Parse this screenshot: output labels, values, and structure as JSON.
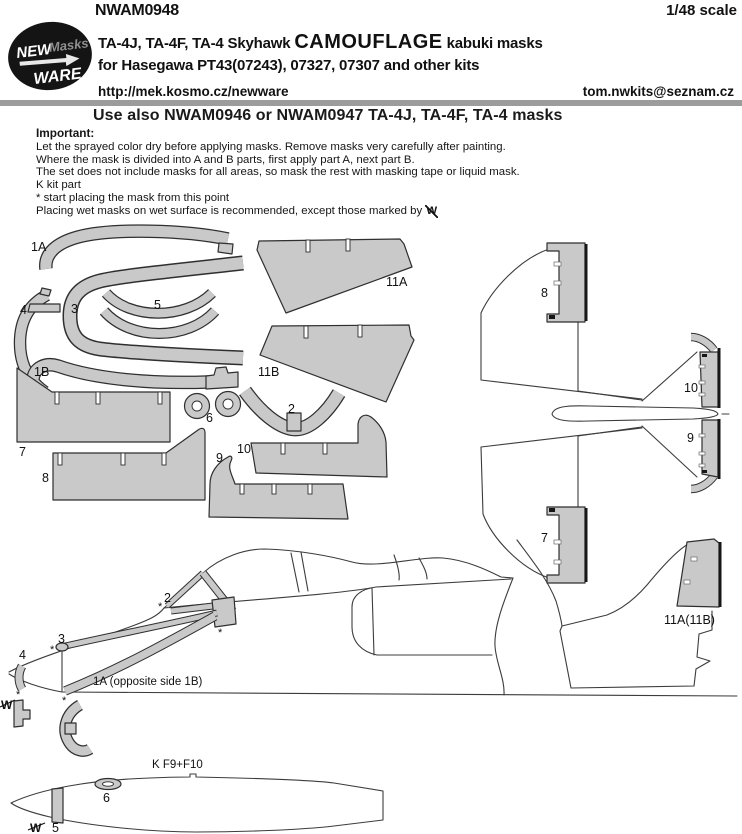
{
  "header": {
    "product_code": "NWAM0948",
    "scale": "1/48 scale",
    "logo": {
      "new": "NEW",
      "masks": "Masks",
      "ware": "WARE"
    },
    "title": {
      "prefix": "TA-4J, TA-4F, TA-4 Skyhawk",
      "highlight": "CAMOUFLAGE",
      "suffix": "kabuki masks"
    },
    "subtitle": "for Hasegawa PT43(07243), 07327, 07307 and other kits",
    "website": "http://mek.kosmo.cz/newware",
    "email": "tom.nwkits@seznam.cz",
    "note": "Use also NWAM0946 or NWAM0947 TA-4J, TA-4F, TA-4 masks"
  },
  "instructions": {
    "heading": "Important:",
    "line1": "Let the sprayed color dry before applying masks. Remove masks very carefully after painting.",
    "line2": "Where the mask is divided into A and B parts, first apply part A, next part B.",
    "line3": "The set does not include masks for all areas, so mask the rest with masking tape or liquid mask.",
    "line4": "K kit part",
    "line5": "* start placing the mask from this point",
    "line6": "Placing wet masks on wet surface is recommended, except those marked by",
    "wet_symbol": "W"
  },
  "diagram": {
    "labels": {
      "n1a": "1A",
      "n1b": "1B",
      "n2": "2",
      "n3": "3",
      "n4": "4",
      "n5": "5",
      "n6": "6",
      "n7": "7",
      "n8": "8",
      "n9": "9",
      "n10": "10",
      "n11a": "11A",
      "n11b": "11B",
      "n11ab": "11A(11B)"
    },
    "side_note": "1A (opposite side 1B)",
    "tank_note": "K F9+F10",
    "wet_symbol": "W",
    "star": "*"
  },
  "colors": {
    "mask_fill": "#c9c9c9",
    "outline": "#2f2f2f",
    "line_art": "#3c3c3c",
    "divider": "#9c9c9c"
  }
}
